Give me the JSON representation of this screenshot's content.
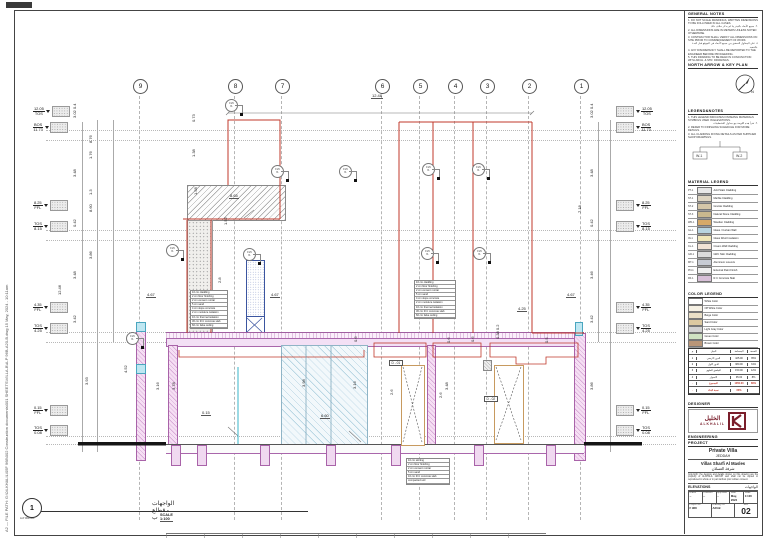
{
  "sheet": {
    "file_path_vertical": "A2 — FILE PATH: G:\\04-KHALIL\\05F 968\\002 Construction documents\\001 SHEETS\\VILLA-B\\A-P 96B-A20-B.dwg   15 May, 2024 - 10:11am"
  },
  "drawing": {
    "grid_bubbles": [
      {
        "t": "9",
        "x": 117
      },
      {
        "t": "8",
        "x": 212
      },
      {
        "t": "7",
        "x": 259
      },
      {
        "t": "6",
        "x": 359
      },
      {
        "t": "5",
        "x": 397
      },
      {
        "t": "4",
        "x": 432
      },
      {
        "t": "3",
        "x": 464
      },
      {
        "t": "2",
        "x": 506
      },
      {
        "t": "1",
        "x": 558
      }
    ],
    "grid_lines": [
      {
        "x": 123
      },
      {
        "x": 218
      },
      {
        "x": 265
      },
      {
        "x": 365
      },
      {
        "x": 403
      },
      {
        "x": 438
      },
      {
        "x": 470
      },
      {
        "x": 512
      },
      {
        "x": 564
      }
    ],
    "dot_lines": [
      {
        "y": 118
      },
      {
        "y": 128
      },
      {
        "y": 218
      },
      {
        "y": 228
      },
      {
        "y": 320
      },
      {
        "y": 330
      },
      {
        "y": 424
      },
      {
        "y": 432
      }
    ],
    "dim_vlines": [
      {
        "x": 66,
        "y": 110,
        "h": 330
      },
      {
        "x": 81,
        "y": 108,
        "h": 332
      },
      {
        "x": 97,
        "y": 108,
        "h": 222
      },
      {
        "x": 582,
        "y": 110,
        "h": 220
      },
      {
        "x": 594,
        "y": 108,
        "h": 332
      }
    ],
    "stubs": [
      {
        "x": 155
      },
      {
        "x": 181
      },
      {
        "x": 244
      },
      {
        "x": 310
      },
      {
        "x": 375
      },
      {
        "x": 458
      },
      {
        "x": 530
      }
    ],
    "elev_left": [
      {
        "x": 33,
        "y": 106,
        "v1": "12.05",
        "v2": "TOS"
      },
      {
        "x": 33,
        "y": 122,
        "v1": "BOS",
        "v2": "11.73"
      },
      {
        "x": 33,
        "y": 200,
        "v1": "8.25",
        "v2": "FFL"
      },
      {
        "x": 33,
        "y": 221,
        "v1": "TOS",
        "v2": "8.15"
      },
      {
        "x": 33,
        "y": 302,
        "v1": "4.35",
        "v2": "FFL"
      },
      {
        "x": 33,
        "y": 323,
        "v1": "TOS",
        "v2": "4.25"
      },
      {
        "x": 33,
        "y": 405,
        "v1": "0.15",
        "v2": "FFL"
      },
      {
        "x": 33,
        "y": 425,
        "v1": "TOS",
        "v2": "0.08"
      }
    ],
    "elev_right": [
      {
        "x": 616,
        "y": 106,
        "v1": "12.05",
        "v2": "TOS"
      },
      {
        "x": 616,
        "y": 122,
        "v1": "BOS",
        "v2": "11.73"
      },
      {
        "x": 616,
        "y": 200,
        "v1": "8.25",
        "v2": "FFL"
      },
      {
        "x": 616,
        "y": 221,
        "v1": "TOS",
        "v2": "8.15"
      },
      {
        "x": 616,
        "y": 302,
        "v1": "4.35",
        "v2": "FFL"
      },
      {
        "x": 616,
        "y": 323,
        "v1": "TOS",
        "v2": "4.25"
      },
      {
        "x": 616,
        "y": 405,
        "v1": "0.15",
        "v2": "FFL"
      },
      {
        "x": 616,
        "y": 425,
        "v1": "TOS",
        "v2": "0.08"
      }
    ],
    "dims": [
      {
        "t": "12.48",
        "x": 371,
        "y": 93,
        "cls": "ul"
      },
      {
        "t": "8.65",
        "x": 229,
        "y": 193,
        "cls": "ul"
      },
      {
        "t": "4.67",
        "x": 146,
        "y": 292,
        "cls": "ul"
      },
      {
        "t": "4.67",
        "x": 270,
        "y": 292,
        "cls": "ul"
      },
      {
        "t": "4.25",
        "x": 211,
        "y": 306,
        "cls": "ul"
      },
      {
        "t": "4.25",
        "x": 517,
        "y": 306,
        "cls": "ul"
      },
      {
        "t": "4.67",
        "x": 566,
        "y": 292,
        "cls": "ul"
      },
      {
        "t": "0.15",
        "x": 201,
        "y": 410,
        "cls": "ul"
      },
      {
        "t": "6.60",
        "x": 320,
        "y": 413,
        "cls": "ul"
      },
      {
        "t": "3.02 0.4",
        "x": 77,
        "y": 113,
        "cls": "rot"
      },
      {
        "t": "8.76",
        "x": 93,
        "y": 138,
        "cls": "rot"
      },
      {
        "t": "1.76",
        "x": 93,
        "y": 154,
        "cls": "rot"
      },
      {
        "t": "3.48",
        "x": 77,
        "y": 172,
        "cls": "rot"
      },
      {
        "t": "1.3",
        "x": 93,
        "y": 190,
        "cls": "rot"
      },
      {
        "t": "8.60",
        "x": 93,
        "y": 207,
        "cls": "rot"
      },
      {
        "t": "0.42",
        "x": 77,
        "y": 222,
        "cls": "rot"
      },
      {
        "t": "3.86",
        "x": 93,
        "y": 254,
        "cls": "rot"
      },
      {
        "t": "3.48",
        "x": 77,
        "y": 274,
        "cls": "rot"
      },
      {
        "t": "12.46",
        "x": 62,
        "y": 290,
        "cls": "rot"
      },
      {
        "t": "3.42",
        "x": 77,
        "y": 318,
        "cls": "rot"
      },
      {
        "t": "3.93",
        "x": 89,
        "y": 380,
        "cls": "rot"
      },
      {
        "t": "4.52",
        "x": 128,
        "y": 368,
        "cls": "rot"
      },
      {
        "t": "0.73",
        "x": 196,
        "y": 117,
        "cls": "rot"
      },
      {
        "t": "1.38",
        "x": 196,
        "y": 152,
        "cls": "rot"
      },
      {
        "t": "1.58",
        "x": 198,
        "y": 190,
        "cls": "rot"
      },
      {
        "t": "1.52",
        "x": 228,
        "y": 220,
        "cls": "rot"
      },
      {
        "t": "2.8",
        "x": 222,
        "y": 278,
        "cls": "rot"
      },
      {
        "t": "3.16",
        "x": 160,
        "y": 385,
        "cls": "rot"
      },
      {
        "t": "3.78",
        "x": 176,
        "y": 385,
        "cls": "rot"
      },
      {
        "t": "3.98",
        "x": 306,
        "y": 382,
        "cls": "rot"
      },
      {
        "t": "3.16",
        "x": 357,
        "y": 384,
        "cls": "rot"
      },
      {
        "t": "2.6",
        "x": 394,
        "y": 390,
        "cls": "rot"
      },
      {
        "t": "3.48",
        "x": 449,
        "y": 385,
        "cls": "rot"
      },
      {
        "t": "2.6",
        "x": 443,
        "y": 393,
        "cls": "rot"
      },
      {
        "t": "0.6",
        "x": 358,
        "y": 337,
        "cls": "rot"
      },
      {
        "t": "0.6",
        "x": 451,
        "y": 338,
        "cls": "rot"
      },
      {
        "t": "0.6",
        "x": 475,
        "y": 337,
        "cls": "rot"
      },
      {
        "t": "0.5",
        "x": 549,
        "y": 338,
        "cls": "rot"
      },
      {
        "t": "0.38 0.2",
        "x": 500,
        "y": 334,
        "cls": "rot"
      },
      {
        "t": "3.02 0.4",
        "x": 594,
        "y": 113,
        "cls": "rot"
      },
      {
        "t": "3.48",
        "x": 594,
        "y": 172,
        "cls": "rot"
      },
      {
        "t": "7.18",
        "x": 582,
        "y": 208,
        "cls": "rot"
      },
      {
        "t": "0.42",
        "x": 594,
        "y": 222,
        "cls": "rot"
      },
      {
        "t": "3.46",
        "x": 594,
        "y": 274,
        "cls": "rot"
      },
      {
        "t": "3.42",
        "x": 594,
        "y": 318,
        "cls": "rot"
      },
      {
        "t": "3.86",
        "x": 594,
        "y": 385,
        "cls": "rot"
      }
    ],
    "tags": [
      {
        "x": 225,
        "y": 99
      },
      {
        "x": 271,
        "y": 165
      },
      {
        "x": 339,
        "y": 165
      },
      {
        "x": 422,
        "y": 163
      },
      {
        "x": 472,
        "y": 163
      },
      {
        "x": 166,
        "y": 244
      },
      {
        "x": 243,
        "y": 248
      },
      {
        "x": 126,
        "y": 332
      },
      {
        "x": 421,
        "y": 247
      },
      {
        "x": 473,
        "y": 247
      }
    ],
    "tag_top": "FL5",
    "tag_bot": "f1",
    "door_labels": [
      {
        "t": "D - 01",
        "x": 389,
        "y": 360
      },
      {
        "t": "D - 02",
        "x": 484,
        "y": 396
      }
    ],
    "spec1": {
      "rows": [
        {
          "t": "10 cm cladding"
        },
        {
          "t": "2 cm floor finishing"
        },
        {
          "t": "2 cm cement mortar"
        },
        {
          "t": "5 cm sand"
        },
        {
          "t": "4 cm slope concrete"
        },
        {
          "t": "2 cm moisture isolation"
        },
        {
          "t": "10 cm thermal isolation"
        },
        {
          "t": "30 cm R.C concrete slab"
        },
        {
          "t": "60 cm false ceiling"
        }
      ]
    },
    "spec2": {
      "rows": [
        {
          "t": "10 cm cladding"
        },
        {
          "t": "2 cm floor finishing"
        },
        {
          "t": "2 cm cement mortar"
        },
        {
          "t": "5 cm sand"
        },
        {
          "t": "4 cm slope concrete"
        },
        {
          "t": "2 cm moisture isolation"
        },
        {
          "t": "10 cm thermal isolation"
        },
        {
          "t": "30 cm R.C concrete slab"
        },
        {
          "t": "60 cm false ceiling"
        }
      ]
    },
    "spec3": {
      "rows": [
        {
          "t": "10 cm skirting"
        },
        {
          "t": "2 cm floor finishing"
        },
        {
          "t": "2 cm cement mortar"
        },
        {
          "t": "5 cm sand"
        },
        {
          "t": "10 cm R.C concrete slab"
        },
        {
          "t": "compacted soil"
        }
      ]
    },
    "view_title": {
      "num": "1",
      "code": "A-P 000-001",
      "title_ar": "الواجهات - قطاع ب",
      "scale": "SCALE  1:100"
    }
  },
  "panel": {
    "general_notes": {
      "label": "GENERAL NOTES",
      "notes": [
        {
          "t": "1. DO NOT SCALE DRAWINGS, WRITTEN DIMENSIONS TO BE FOLLOWED IN ALL CASES."
        },
        {
          "t": "٢. جميع الأبعاد بالمتر ما لم يذكر خلاف ذلك.",
          "cls": "ar"
        },
        {
          "t": "2. ALL DIMENSIONS ARE IN METERS UNLESS NOTED OTHERWISE."
        },
        {
          "t": "3. CONTRACTOR SHALL VERIFY ALL DIMENSIONS ON SITE PRIOR TO COMMENCEMENT OF WORK."
        },
        {
          "t": "٤. على المقاول التحقق من جميع الأبعاد في الموقع قبل البدء بالتنفيذ.",
          "cls": "ar"
        },
        {
          "t": "4. ANY DISCREPANCY SHALL BE REPORTED TO THE ENGINEER BEFORE PROCEEDING."
        },
        {
          "t": "5. THIS DRAWING TO BE READ IN CONJUNCTION WITH ARCH. & STR. DRAWINGS."
        }
      ]
    },
    "north": {
      "label": "NORTH ARROW & KEY PLAN",
      "letter": "N"
    },
    "legend": {
      "label": "LEGEND&NOTES",
      "notes": [
        {
          "t": "1. THIS LEGEND INDICATES FINISHING MATERIALS SYMBOLS USED IN ELEVATIONS."
        },
        {
          "t": "٢. تقرأ هذه اللوحة مع جداول التشطيبات.",
          "cls": "ar"
        },
        {
          "t": "2. REFER TO FINISHING SCHEDULE FOR MORE DETAILS."
        },
        {
          "t": "3. ALL CLADDING FIXING DETAILS AS PER SUPPLIER SHOP DRAWINGS."
        }
      ],
      "tree_a": "W-1",
      "tree_b": "W-2"
    },
    "material_legend": {
      "label": "MATERIAL LEGEND",
      "rows": [
        {
          "code": "PT-1",
          "swatch": "#e8e8e8",
          "name": "Acid Stain Cladding"
        },
        {
          "code": "ST-1",
          "swatch": "#ded5c2",
          "name": "Marble Cladding"
        },
        {
          "code": "ST-2",
          "swatch": "#d4c6a8",
          "name": "Granite Cladding"
        },
        {
          "code": "ST-3",
          "swatch": "#c9b88e",
          "name": "Natural Stone Cladding"
        },
        {
          "code": "WD-1",
          "swatch": "#d6a968",
          "name": "Wooden Cladding"
        },
        {
          "code": "GL-1",
          "swatch": "#b8d4e0",
          "name": "Glass / Curtain Wall"
        },
        {
          "code": "IN-1",
          "swatch": "#f0e6b8",
          "name": "Glass Wool Insulation"
        },
        {
          "code": "CL-1",
          "swatch": "#f2e3d5",
          "name": "Cream Wall Cladding"
        },
        {
          "code": "GR-1",
          "swatch": "#dcdcdc",
          "name": "GRC Skin Cladding"
        },
        {
          "code": "MT-1",
          "swatch": "#c8ccd4",
          "name": "Aluminum Louvers"
        },
        {
          "code": "PN-1",
          "swatch": "#efefef",
          "name": "External Paint Finish"
        },
        {
          "code": "RF-1",
          "swatch": "#d8c0d8",
          "name": "R.C Concrete Slab"
        }
      ]
    },
    "color_legend": {
      "label": "COLOR LEGEND",
      "rows": [
        {
          "swatch": "#ffffff",
          "name": "White Color"
        },
        {
          "swatch": "#f6f1e4",
          "name": "Off White Color"
        },
        {
          "swatch": "#eadfc6",
          "name": "Beige Color"
        },
        {
          "swatch": "#dcc9a1",
          "name": "Sand Color"
        },
        {
          "swatch": "#d2d2d2",
          "name": "Light Gray Color"
        },
        {
          "swatch": "#cfe2c2",
          "name": "Green Color"
        },
        {
          "swatch": "#b99678",
          "name": "Brown Color"
        }
      ]
    },
    "area_table": {
      "rows": [
        {
          "c1": "م",
          "c2": "البيان",
          "c3": "المساحة",
          "c4": "النسبة"
        },
        {
          "c1": "1",
          "c2": "الدور الأرضي",
          "c3": "425.00",
          "c4": "35%"
        },
        {
          "c1": "2",
          "c2": "الدور الأول",
          "c3": "380.00",
          "c4": "31%"
        },
        {
          "c1": "3",
          "c2": "الملحق العلوي",
          "c3": "150.00",
          "c4": "12%"
        },
        {
          "c1": "4",
          "c2": "الأسوار",
          "c3": "95.00",
          "c4": "8%"
        },
        {
          "c1": "-",
          "c2": "المجموع",
          "c3": "1050.00",
          "c4": "86%",
          "cls": "red"
        },
        {
          "c1": "-",
          "c2": "نسبة البناء",
          "c3": "60%",
          "c4": "",
          "cls": "red"
        }
      ]
    },
    "designer": {
      "label": "DESIGNER",
      "logo_ar": "الخليل",
      "logo_en": "ALKHALIL",
      "eng_label": "ENGINEERING"
    },
    "project": {
      "label": "PROJECT",
      "name": "Private Villa",
      "city": "JEDDAH",
      "client_en": "Villas Sharfi Al Masles",
      "client_ar": "شرفة العسلان",
      "disclaimer": "Copyright: the designs and details shown on this drawing are the property of ALKHALIL GROUP and shall not be copied or reproduced in whole or in part without prior written consent.",
      "dwg_title_en": "ELEVATIONS",
      "dwg_title_ar": "الواجهات",
      "fields": {
        "drawn": {
          "label": "Drawn",
          "value": "--"
        },
        "checked": {
          "label": "Checked",
          "value": "--"
        },
        "approved": {
          "label": "Approved",
          "value": "--"
        },
        "date": {
          "label": "Date",
          "value": "May, 2024"
        },
        "scale": {
          "label": "Scale",
          "value": "1:100"
        },
        "project_no": {
          "label": "Project No.",
          "value": "F 968"
        },
        "drawing_no": {
          "label": "Drawing No.",
          "value": "A20-B"
        },
        "rev": {
          "label": "Rev.",
          "value": "02"
        }
      }
    }
  }
}
